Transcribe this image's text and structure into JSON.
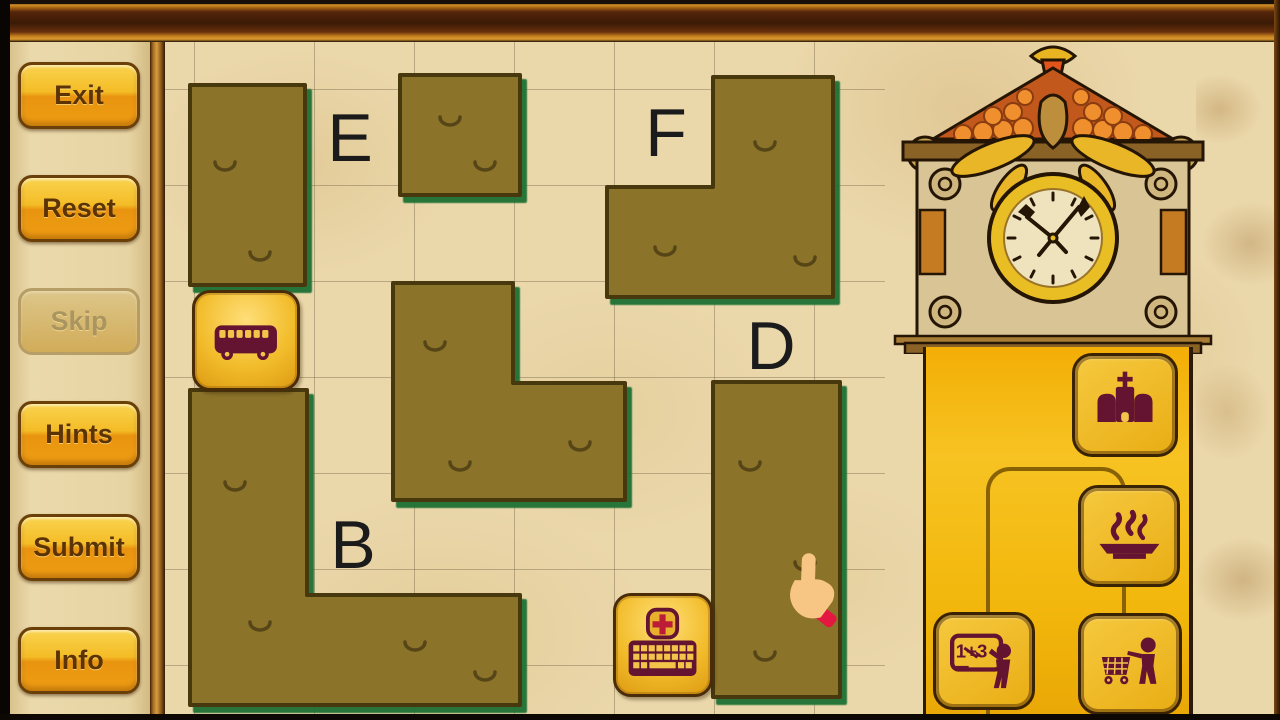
{
  "sidebar": {
    "buttons": [
      {
        "name": "exit-button",
        "label": "Exit",
        "enabled": true
      },
      {
        "name": "reset-button",
        "label": "Reset",
        "enabled": true
      },
      {
        "name": "skip-button",
        "label": "Skip",
        "enabled": false
      },
      {
        "name": "hints-button",
        "label": "Hints",
        "enabled": true
      },
      {
        "name": "submit-button",
        "label": "Submit",
        "enabled": true
      },
      {
        "name": "info-button",
        "label": "Info",
        "enabled": true
      }
    ]
  },
  "board": {
    "grid": {
      "cols": 7,
      "rows": 7,
      "cell_width": 100,
      "cell_height": 96
    },
    "labels": [
      {
        "text": "E",
        "x": 185,
        "y": 96
      },
      {
        "text": "F",
        "x": 501,
        "y": 91
      },
      {
        "text": "D",
        "x": 606,
        "y": 304
      },
      {
        "text": "B",
        "x": 188,
        "y": 503
      }
    ],
    "pieces": [
      {
        "name": "hedge-e-column",
        "points": [
          [
            25,
            43
          ],
          [
            140,
            43
          ],
          [
            140,
            243
          ],
          [
            25,
            243
          ]
        ],
        "marks": [
          [
            60,
            120
          ],
          [
            95,
            210
          ]
        ]
      },
      {
        "name": "hedge-top-square",
        "points": [
          [
            235,
            33
          ],
          [
            355,
            33
          ],
          [
            355,
            153
          ],
          [
            235,
            153
          ]
        ],
        "marks": [
          [
            285,
            75
          ],
          [
            320,
            120
          ]
        ]
      },
      {
        "name": "hedge-f-corner",
        "points": [
          [
            548,
            35
          ],
          [
            668,
            35
          ],
          [
            668,
            255
          ],
          [
            442,
            255
          ],
          [
            442,
            145
          ],
          [
            548,
            145
          ]
        ],
        "marks": [
          [
            600,
            100
          ],
          [
            500,
            205
          ],
          [
            640,
            215
          ]
        ]
      },
      {
        "name": "hedge-mid-corner",
        "points": [
          [
            228,
            241
          ],
          [
            348,
            241
          ],
          [
            348,
            341
          ],
          [
            460,
            341
          ],
          [
            460,
            458
          ],
          [
            228,
            458
          ]
        ],
        "marks": [
          [
            270,
            300
          ],
          [
            295,
            420
          ],
          [
            415,
            400
          ]
        ]
      },
      {
        "name": "hedge-d-column",
        "points": [
          [
            548,
            340
          ],
          [
            675,
            340
          ],
          [
            675,
            655
          ],
          [
            548,
            655
          ]
        ],
        "marks": [
          [
            585,
            420
          ],
          [
            640,
            520
          ],
          [
            600,
            610
          ]
        ]
      },
      {
        "name": "hedge-b-corner",
        "points": [
          [
            25,
            348
          ],
          [
            142,
            348
          ],
          [
            142,
            553
          ],
          [
            355,
            553
          ],
          [
            355,
            663
          ],
          [
            25,
            663
          ]
        ],
        "marks": [
          [
            70,
            440
          ],
          [
            95,
            580
          ],
          [
            250,
            600
          ],
          [
            320,
            630
          ]
        ]
      }
    ],
    "tiles": [
      {
        "name": "bus-tile",
        "icon": "bus",
        "x": 27,
        "y": 248,
        "w": 108,
        "h": 101
      },
      {
        "name": "keyboard-tile",
        "icon": "keyboard-cross",
        "x": 448,
        "y": 551,
        "w": 100,
        "h": 104
      }
    ],
    "cursor": {
      "name": "hand-cursor",
      "icon": "hand",
      "x": 616,
      "y": 511,
      "w": 64,
      "h": 84
    }
  },
  "right_panel": {
    "buttons": [
      {
        "name": "church-button",
        "icon": "church",
        "x": 907,
        "y": 311,
        "w": 106,
        "h": 104
      },
      {
        "name": "dish-button",
        "icon": "dish",
        "x": 913,
        "y": 443,
        "w": 102,
        "h": 102
      },
      {
        "name": "school-button",
        "icon": "school",
        "icon_text": "1+3",
        "x": 768,
        "y": 570,
        "w": 102,
        "h": 98
      },
      {
        "name": "cart-button",
        "icon": "cart",
        "x": 913,
        "y": 571,
        "w": 104,
        "h": 102
      }
    ]
  },
  "colors": {
    "hedge": "#8b7329",
    "hedge_outline": "#46390f",
    "hedge_shadow": "#1e7030",
    "hedge_mark": "#564416",
    "icon_maroon": "#641430",
    "icon_gold": "#f2c44a",
    "icon_red": "#bd1c38",
    "skin": "#f8c684",
    "cuff_red": "#e3173f",
    "tile_gold": "#f2bd2c",
    "column_yellow": "#f5b90d",
    "parchment": "#ead7aa",
    "button_gold": "#f3b722"
  }
}
